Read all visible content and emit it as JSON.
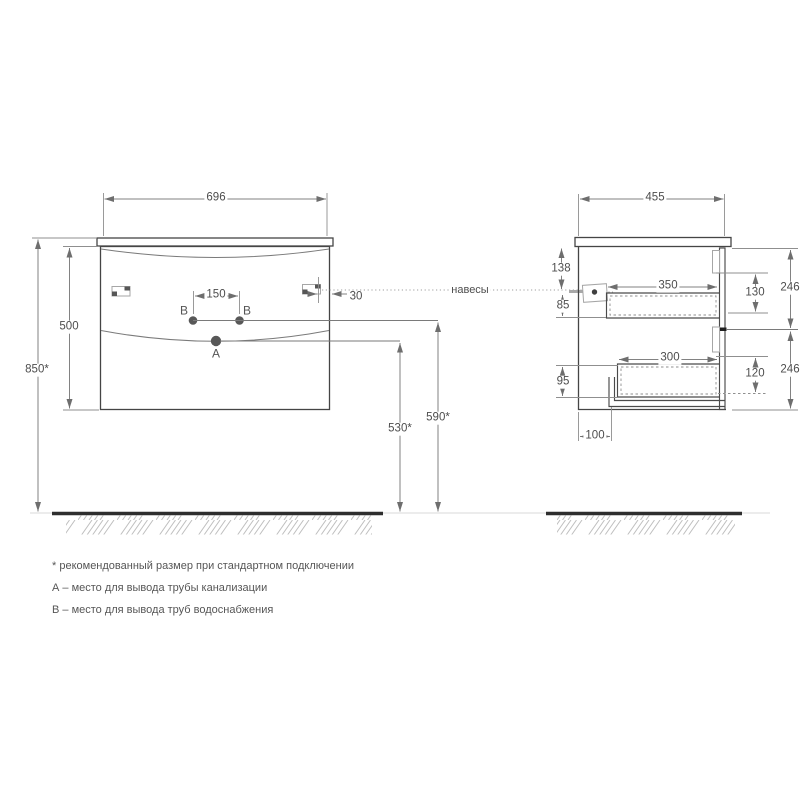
{
  "front_view": {
    "width": "696",
    "body_height": "500",
    "mount_height": "850*",
    "outlet_spacing": "150",
    "hanger_offset": "30",
    "siphon_height": "530*",
    "water_height": "590*",
    "point_a": "A",
    "point_b_left": "B",
    "point_b_right": "B"
  },
  "side_view": {
    "depth": "455",
    "top_to_hanger": "138",
    "hanger_to_drawer": "85",
    "drawer_top_depth": "350",
    "drawer_top_height": "130",
    "front_top_height": "246",
    "drawer_bottom_depth": "300",
    "drawer_bottom_height": "120",
    "front_bottom_height": "246",
    "bottom_gap": "95",
    "drain_offset": "100"
  },
  "annotations": {
    "hangers_label": "навесы"
  },
  "footnotes": {
    "recommended": "* рекомендованный размер при стандартном подключении",
    "point_a": "А – место для вывода трубы канализации",
    "point_b": "В – место для вывода труб водоснабжения"
  },
  "colors": {
    "outline": "#454545",
    "dimension": "#828282",
    "floor": "#2e2e2e",
    "text": "#4d4d4d"
  }
}
